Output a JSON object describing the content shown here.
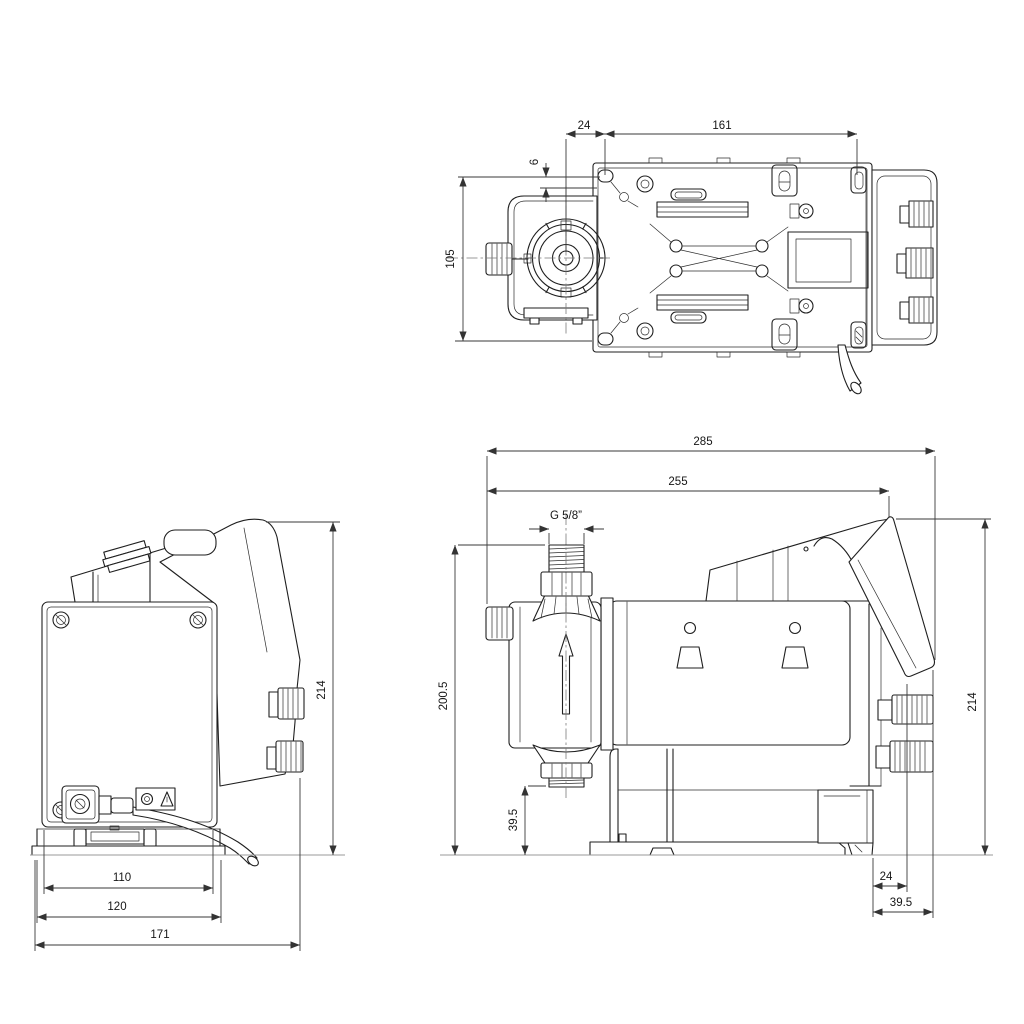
{
  "colors": {
    "background": "#ffffff",
    "line": "#1f1f1f",
    "dimension_text": "#161616",
    "reference_line": "#9a9a9a"
  },
  "views": {
    "top": {
      "dims": {
        "head_to_hole": "24",
        "hole_span": "161",
        "edge_offset": "6",
        "hole_row_span": "105"
      }
    },
    "back": {
      "dims": {
        "height": "214",
        "inner_width": "110",
        "base_width": "120",
        "overall_width": "171"
      }
    },
    "side": {
      "dims": {
        "overall_length": "285",
        "body_length": "255",
        "thread": "G 5/8”",
        "port_height": "200.5",
        "port_clearance": "39.5",
        "height": "214",
        "foot_offset": "24",
        "foot_depth": "39.5"
      }
    }
  }
}
